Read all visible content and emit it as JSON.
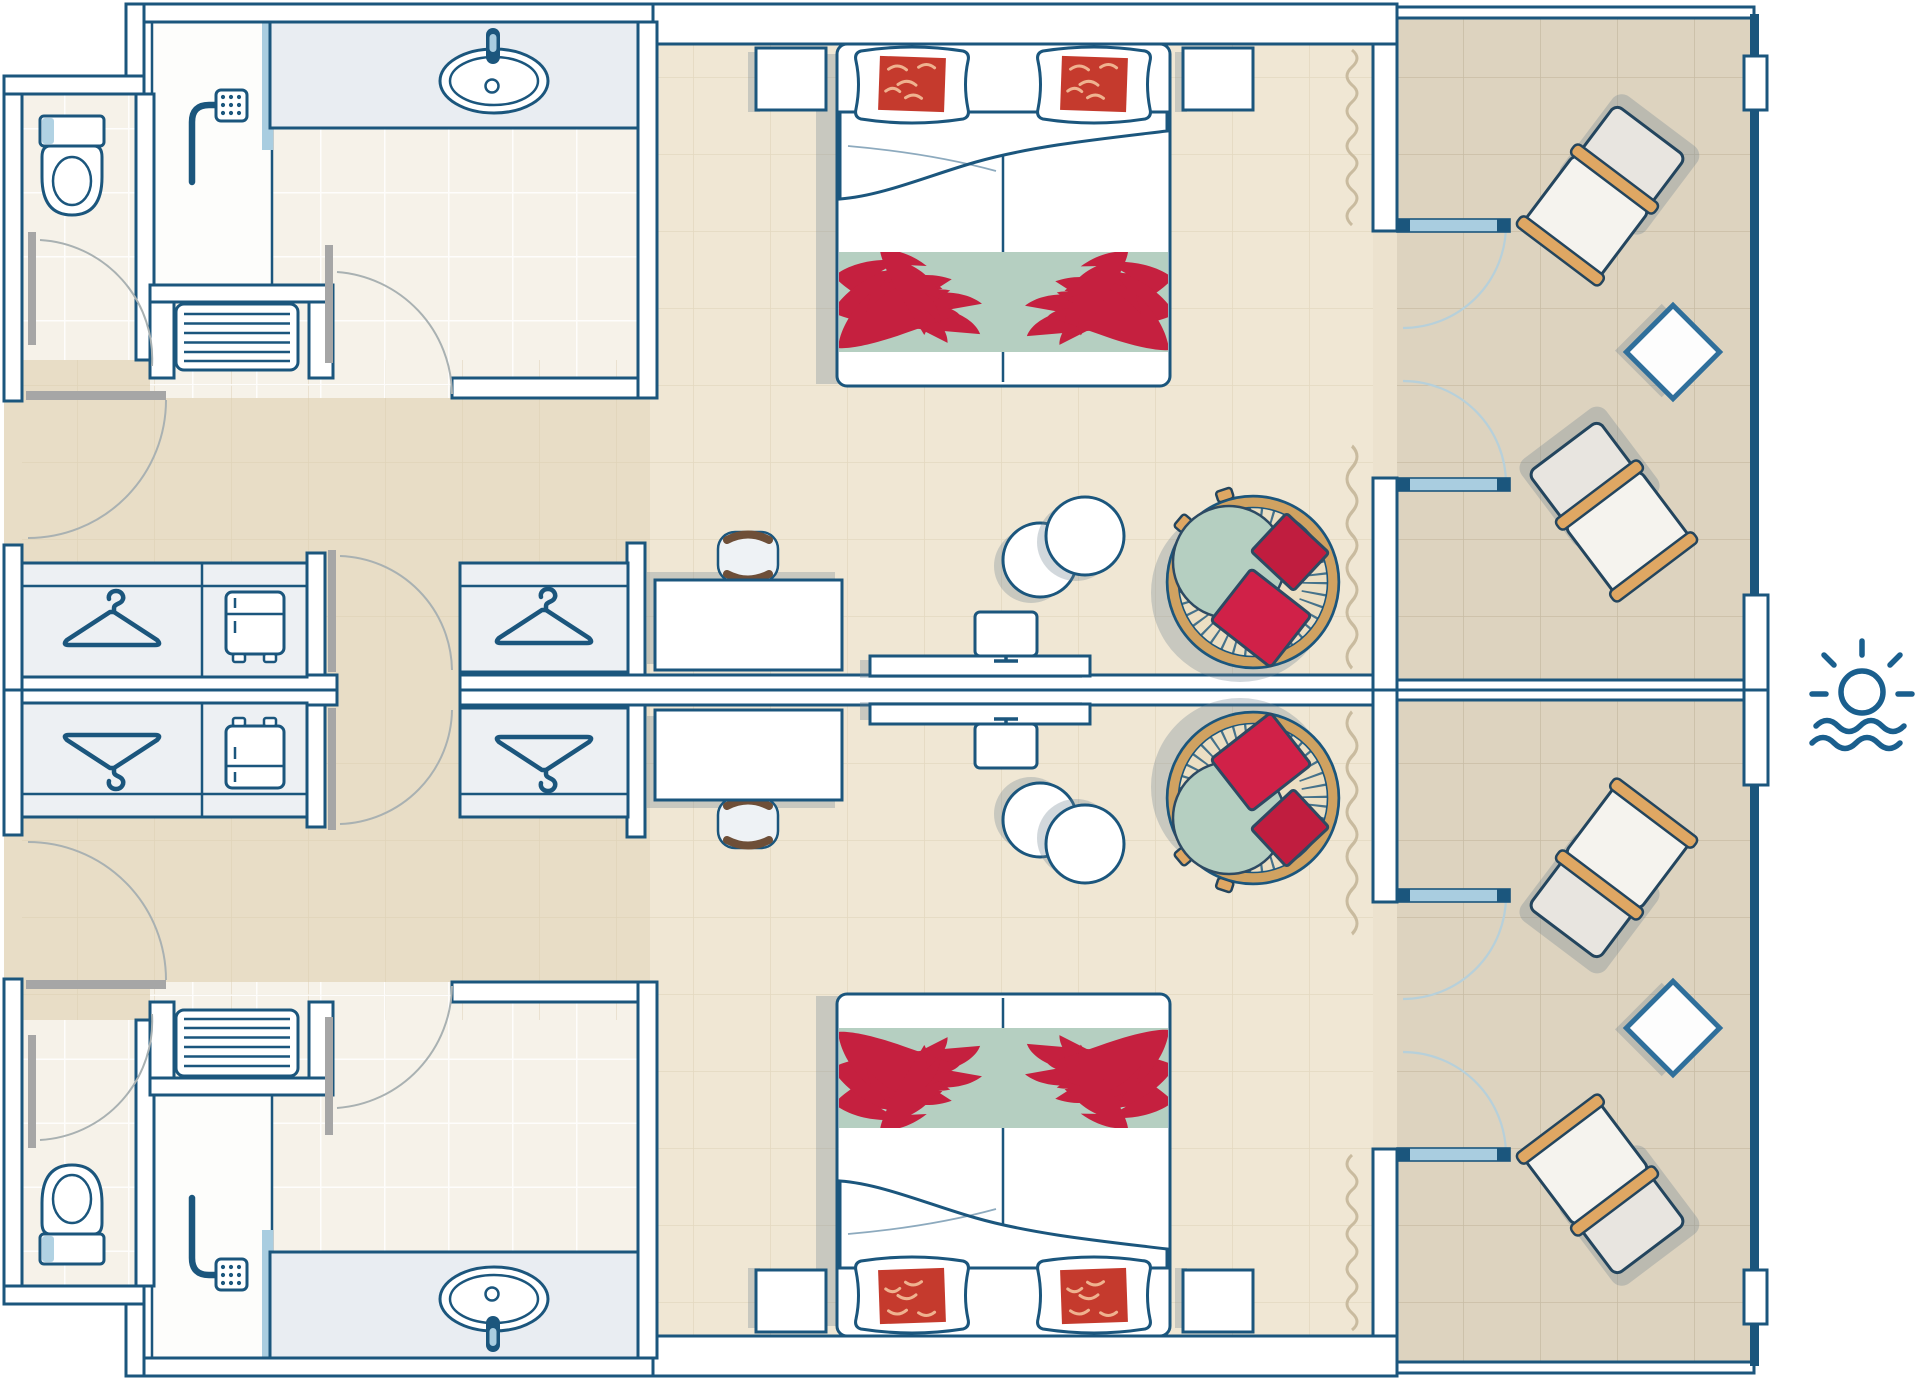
{
  "page": {
    "kind": "hotel-room-floor-plan",
    "visible_text": [],
    "units": [
      {
        "name": "room-unit-top",
        "mirrored": false
      },
      {
        "name": "room-unit-bottom",
        "mirrored": true
      }
    ]
  },
  "objects_per_unit": {
    "bathroom": [
      "toilet",
      "shower-with-head-icon",
      "shower-glass",
      "washbasin-counter",
      "washbasin",
      "faucet",
      "luggage-bench-slatted",
      "bathroom-door",
      "wc-door"
    ],
    "hallway": [
      "entrance-door",
      "wardrobe-hanger-icon",
      "minibar-fridge-icon",
      "second-wardrobe-hanger-icon",
      "connecting-door"
    ],
    "bedroom": [
      "double-bed",
      "two-pillows-with-red-cushions",
      "duvet",
      "palm-leaf-bed-runner",
      "nightstand-left",
      "nightstand-right",
      "desk",
      "tub-chair",
      "tv-sideboard",
      "tv-monitor-icon",
      "two-round-side-tables",
      "rattan-round-lounge-chair-with-cushions",
      "curtain-squiggle",
      "french-doors-to-terrace"
    ],
    "terrace": [
      "sun-lounger-upper",
      "diamond-side-table",
      "sun-lounger-lower"
    ]
  },
  "legend_icons": [
    "sun-over-sea-icon"
  ],
  "colors": {
    "wall_stroke": "#1b567d",
    "leaf_gray": "#a6a6a6",
    "arc_gray": "#a9b1b2",
    "arc_glass": "#b7d0da",
    "glass": "#a9cde0",
    "floor_room": "#f0e7d4",
    "floor_corridor": "#e8ddc6",
    "floor_bath": "#f6f2e9",
    "floor_terrace": "#ddd3bf",
    "floor_threshold": "#ece2ce",
    "furn_light": "#edf0f3",
    "shadow": "rgba(115,135,145,0.32)",
    "rattan": "#d0a261",
    "wood": "#dfa763",
    "green": "#b5cfc1",
    "red_pillow": "#c01d3f",
    "red_pillow2": "#d02148",
    "red_cushion": "#c53a2d",
    "cushion_stroke": "#2d4a63",
    "palm": "#c5203f",
    "sun": "#1a5f8e",
    "brown": "#6e4f38",
    "squiggle": "#c9bb9f"
  }
}
